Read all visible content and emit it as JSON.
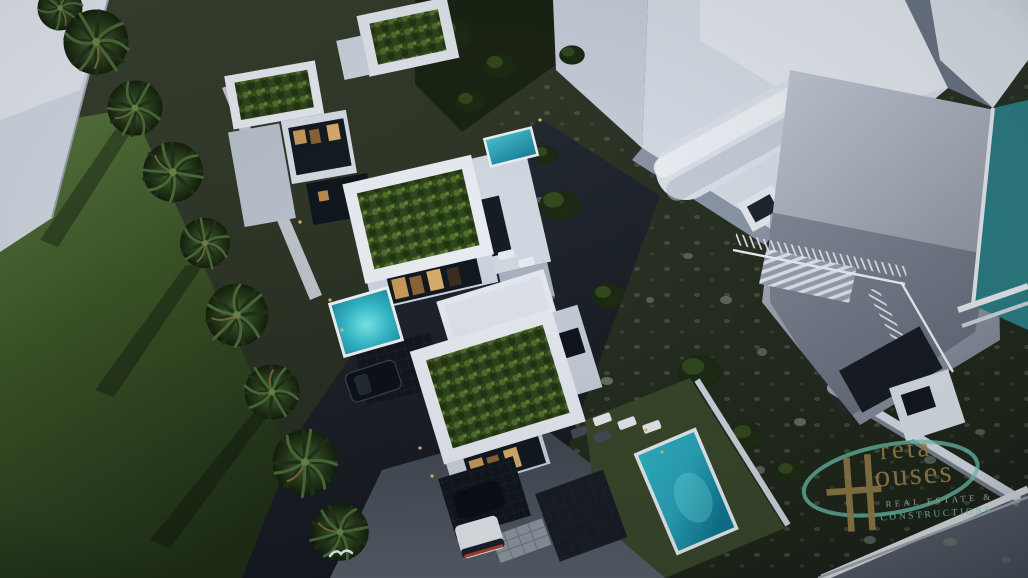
{
  "image": {
    "type": "aerial-3d-architectural-render",
    "subject": "modern white villa complex with planted green roofs, private pools, palm-lined street and hillside, rendered at dusk"
  },
  "watermark": {
    "brand": "Creta Houses",
    "fragment_top": "reta",
    "fragment_bottom": "ouses",
    "tagline_line1": "REAL ESTATE &",
    "tagline_line2": "CONSTRUCTIONS"
  },
  "palette": {
    "building_white": "#e7ebf1",
    "building_shadow": "#9aa4b4",
    "green_roof": "#31451d",
    "lawn_green": "#4e6b35",
    "hillside_green": "#2b3325",
    "asphalt": "#20252d",
    "driveway_gray": "#4d545e",
    "pool_cyan": "#3ec8d5",
    "pool_teal": "#2c7e84",
    "window_warm": "#c89a58",
    "logo_gold": "#8a7544",
    "logo_teal": "#63b4a2",
    "tagline_gray": "#96a298"
  },
  "scene_counts": {
    "green_roof_villas": 3,
    "pools": 4,
    "palm_trees": 9,
    "vehicles": 3,
    "birds": 1
  }
}
